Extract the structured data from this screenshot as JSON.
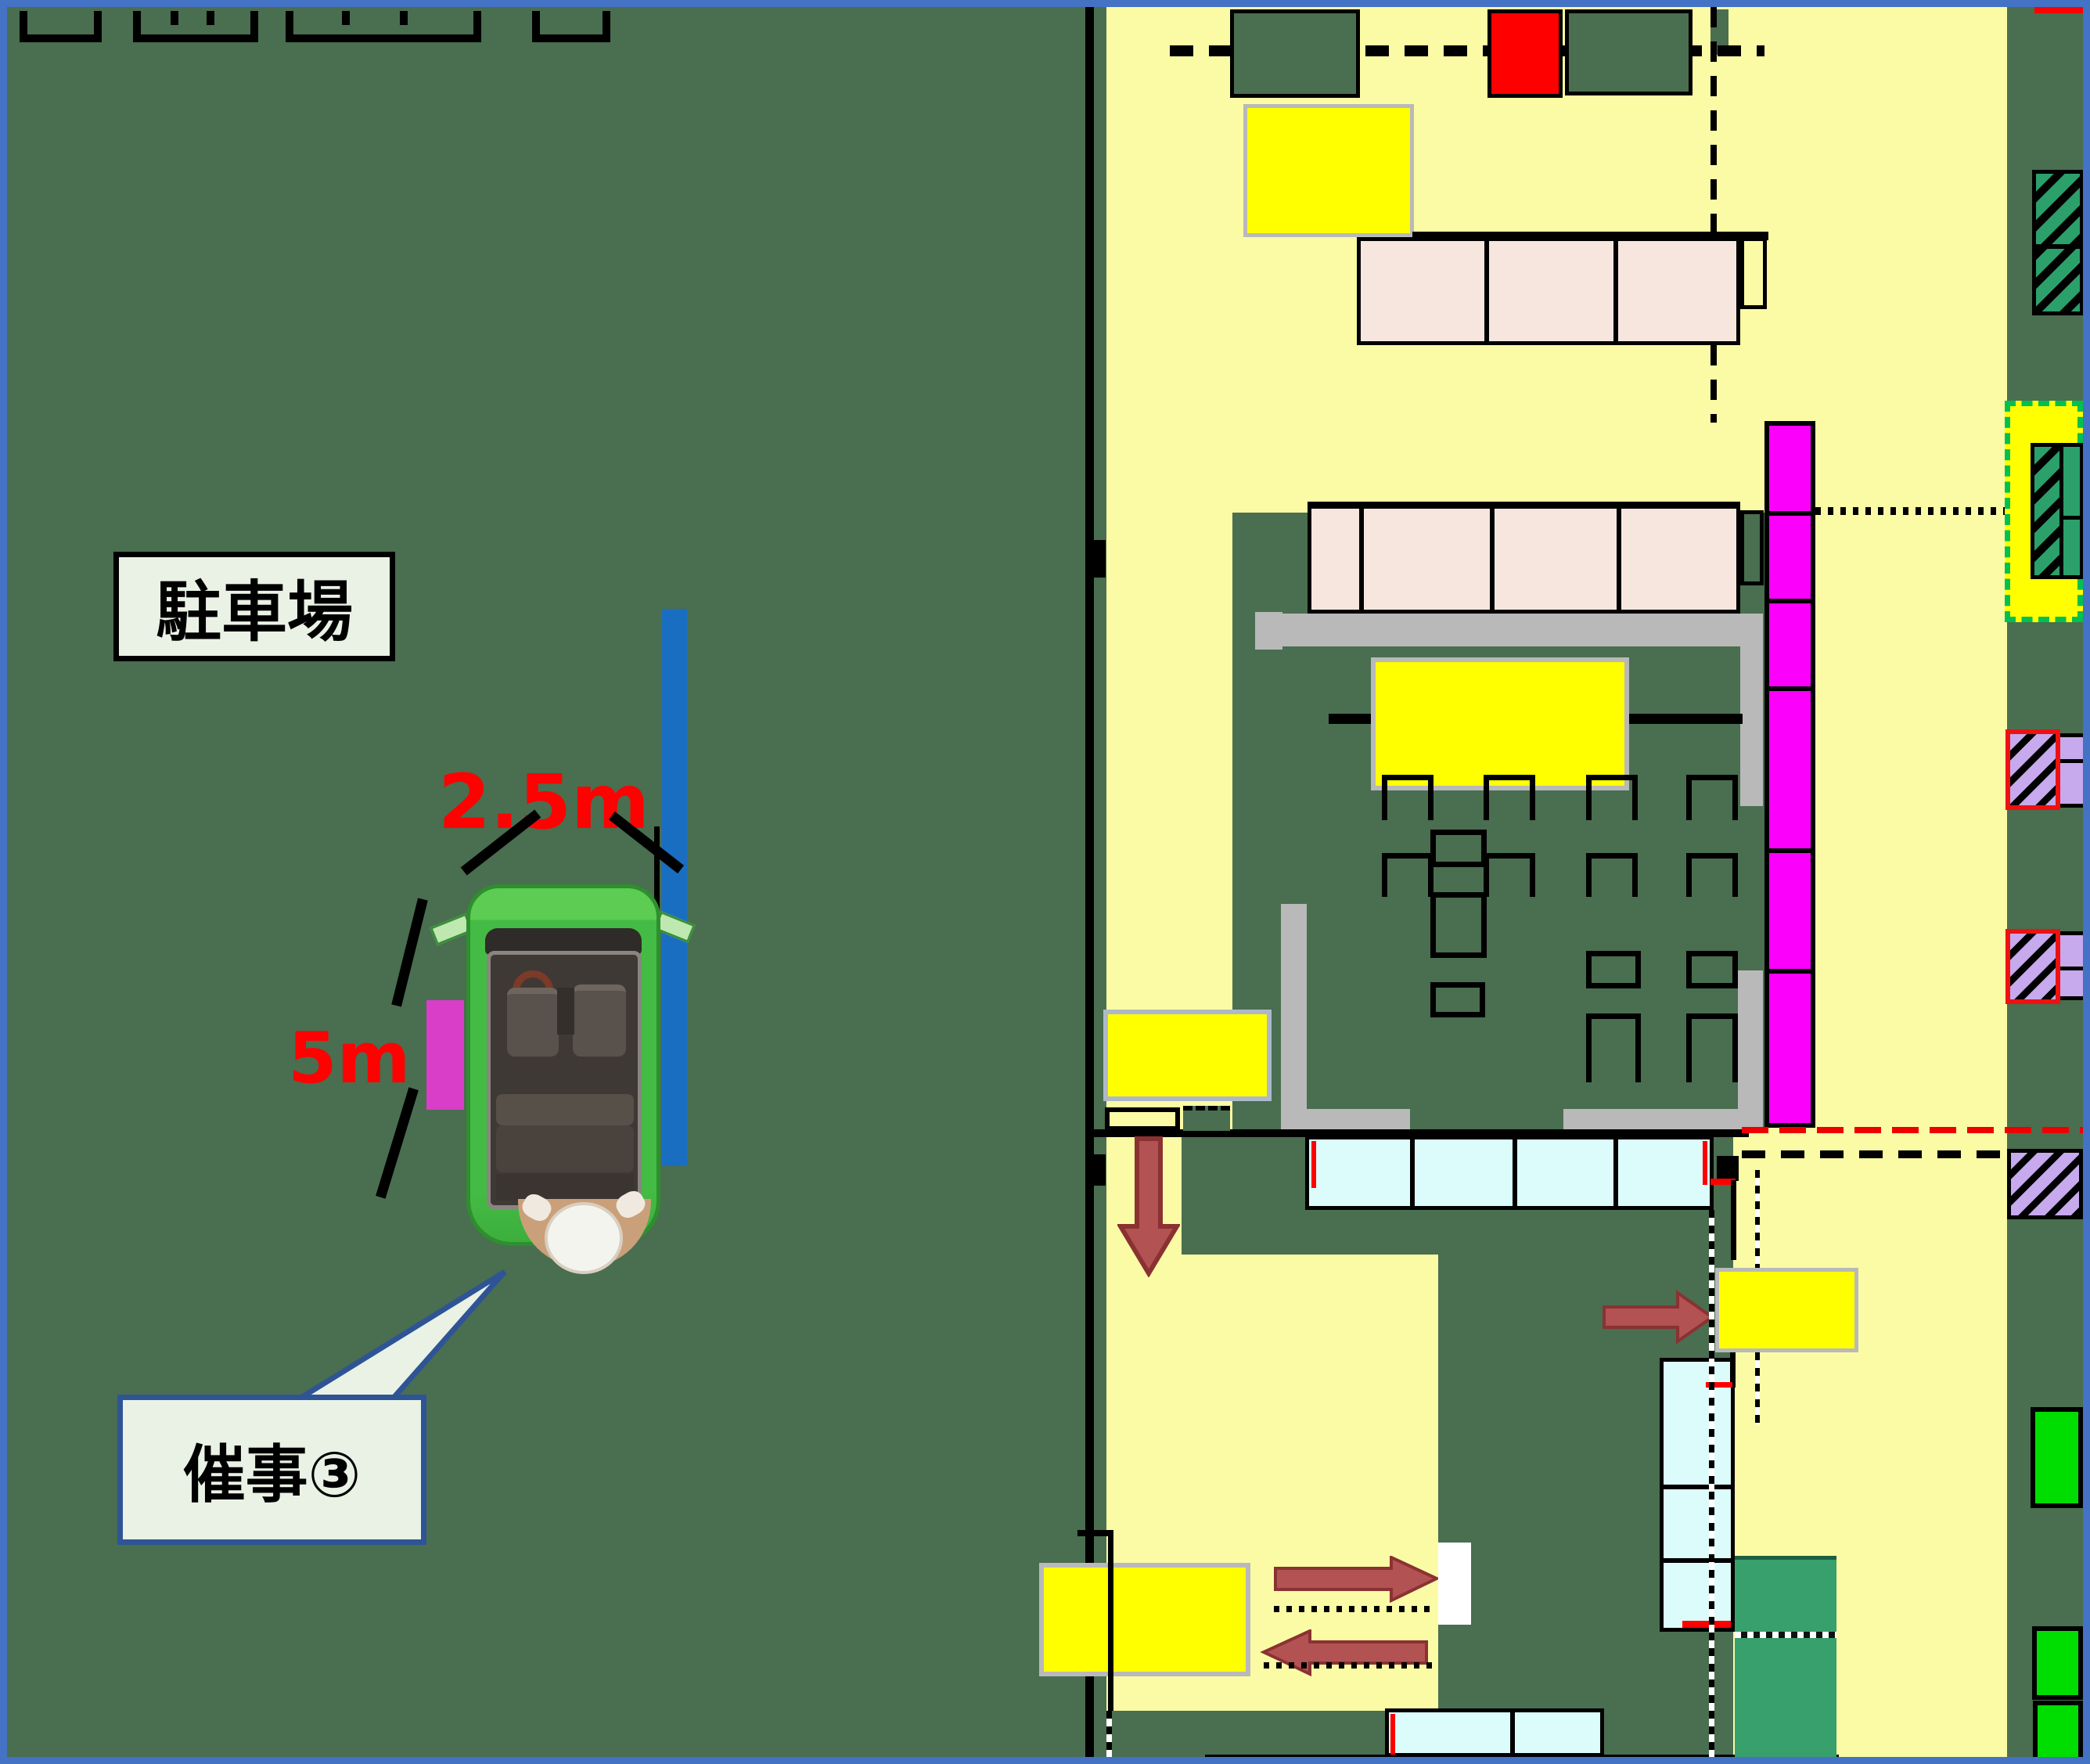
{
  "scene": "store-floor-plan-with-parking-lot",
  "labels": {
    "parking": "駐車場",
    "dim_width": "2.5m",
    "dim_length": "5m",
    "callout": "催事③"
  },
  "colors": {
    "frame_blue": "#4472c4",
    "parking_green": "#4a6e50",
    "floor_yellow": "#fbfba6",
    "highlight_yellow": "#ffff00",
    "shelf_pink": "#f6e6de",
    "magenta_fixture": "#fb00fb",
    "gray_counter": "#b9b9b9",
    "cyan_case": "#dcfbfb",
    "sea_green_case": "#37a06c",
    "bright_green_case": "#00dd00",
    "teal_hatch_case": "#2ba06a",
    "purple_hatch_case": "#c7a9ee",
    "alert_red": "#ff0000",
    "arrow_red": "#b35252",
    "label_fill": "#e9f2e5",
    "callout_border": "#2f5496",
    "partition_blue": "#1a6ec2",
    "vehicle_green": "#44bb44",
    "door_magenta": "#d93ec9"
  },
  "annotations": {
    "vehicle": "green-minivan-top-view",
    "person": "staff-at-rear-of-vehicle",
    "flow_arrows": [
      "down",
      "right-short",
      "right-long",
      "left-long"
    ]
  }
}
